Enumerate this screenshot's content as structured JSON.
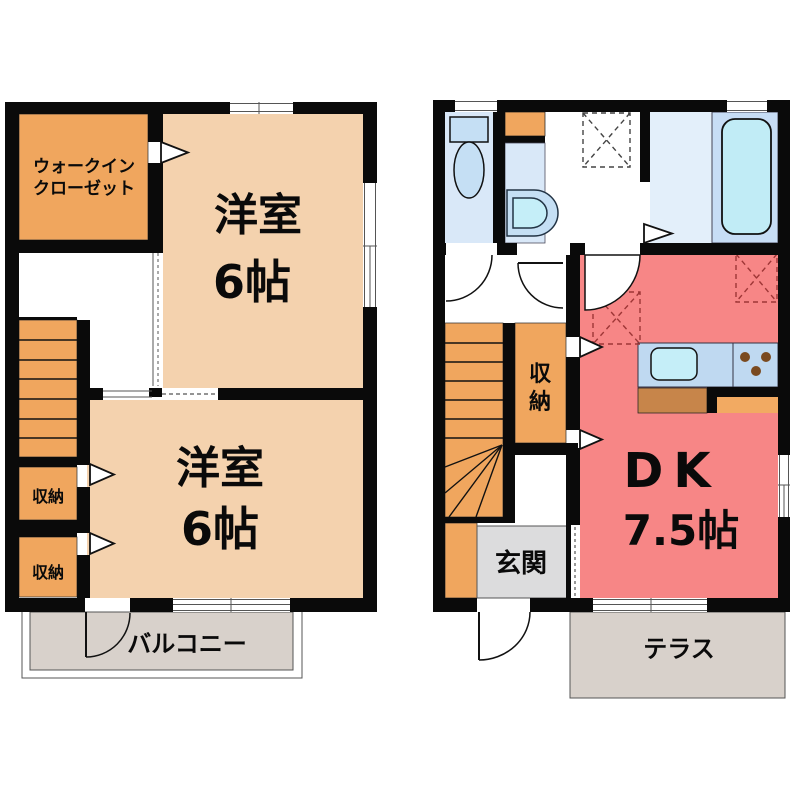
{
  "colors": {
    "wall": "#0a0a0a",
    "room_tan": "#f4d2ae",
    "orange": "#f0a65e",
    "red": "#f78686",
    "light_blue": "#d9e8f8",
    "bath_floor": "#e3effa",
    "tub_panel": "#c7ddf5",
    "tub_fill": "#c1ecf6",
    "fixture_blue": "#c5dff4",
    "counter_blue": "#bfd9f1",
    "sink_cyan": "#c5eef8",
    "cabinet_brown": "#c7854a",
    "cabinet_orange": "#f2aa62",
    "balcony_grey": "#d8d1cb",
    "entrance_grey": "#dcdcdd",
    "burner_brown": "#7a4a20"
  },
  "floor2": {
    "walk_in_closet": {
      "line1": "ウォークイン",
      "line2": "クローゼット"
    },
    "bedroom_upper": {
      "name": "洋室",
      "size": "6帖"
    },
    "bedroom_lower": {
      "name": "洋室",
      "size": "6帖"
    },
    "storage_upper": {
      "label": "収納"
    },
    "storage_lower": {
      "label": "収納"
    },
    "balcony": {
      "label": "バルコニー"
    }
  },
  "floor1": {
    "dining_kitchen": {
      "name": "DK",
      "size": "7.5帖"
    },
    "storage": {
      "label": "収納"
    },
    "entrance": {
      "label": "玄関"
    },
    "terrace": {
      "label": "テラス"
    }
  }
}
